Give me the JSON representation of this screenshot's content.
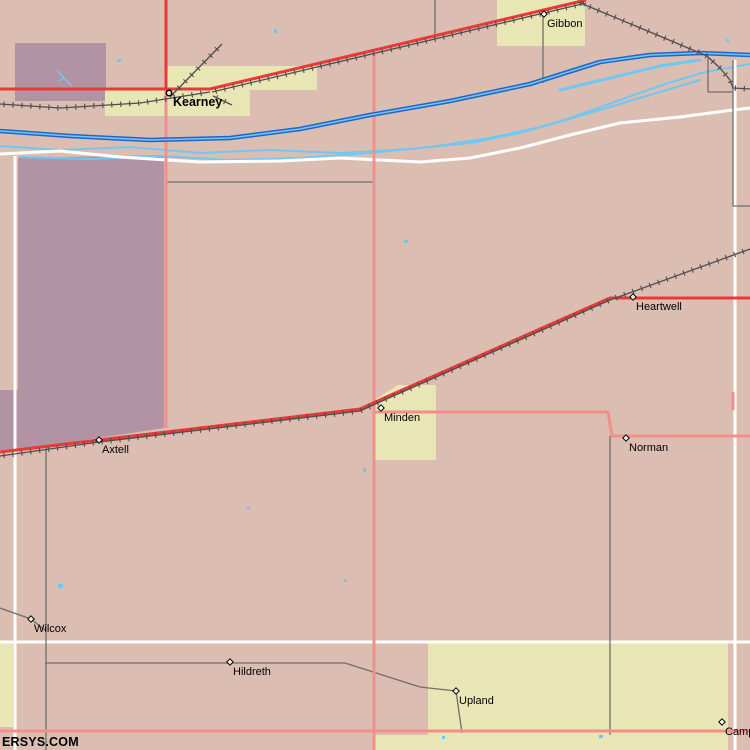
{
  "map": {
    "attribution": "ERSYS.COM",
    "towns": [
      {
        "name": "Kearney",
        "x": 169,
        "y": 93,
        "marker": "circle",
        "emphasis": true
      },
      {
        "name": "Gibbon",
        "x": 544,
        "y": 14,
        "marker": "diamond",
        "emphasis": false
      },
      {
        "name": "Heartwell",
        "x": 633,
        "y": 297,
        "marker": "diamond",
        "emphasis": false
      },
      {
        "name": "Minden",
        "x": 381,
        "y": 408,
        "marker": "diamond",
        "emphasis": false
      },
      {
        "name": "Norman",
        "x": 626,
        "y": 438,
        "marker": "diamond",
        "emphasis": false
      },
      {
        "name": "Axtell",
        "x": 99,
        "y": 440,
        "marker": "diamond",
        "emphasis": false
      },
      {
        "name": "Wilcox",
        "x": 31,
        "y": 619,
        "marker": "diamond",
        "emphasis": false
      },
      {
        "name": "Hildreth",
        "x": 230,
        "y": 662,
        "marker": "diamond",
        "emphasis": false
      },
      {
        "name": "Upland",
        "x": 456,
        "y": 691,
        "marker": "diamond",
        "emphasis": false
      },
      {
        "name": "Camp",
        "x": 722,
        "y": 722,
        "marker": "diamond",
        "emphasis": false
      }
    ],
    "palette": {
      "background": "#dcbdb2",
      "district": "#b293a3",
      "urban": "#e9e6b6",
      "highway": "#e93a38",
      "road": "#f28e8c",
      "river": "#2265c8",
      "river_light": "#70c8f2",
      "boundary": "#ffffff",
      "county_road": "#6e6e6e",
      "railroad": "#4e4e4e",
      "label": "#000000"
    }
  }
}
